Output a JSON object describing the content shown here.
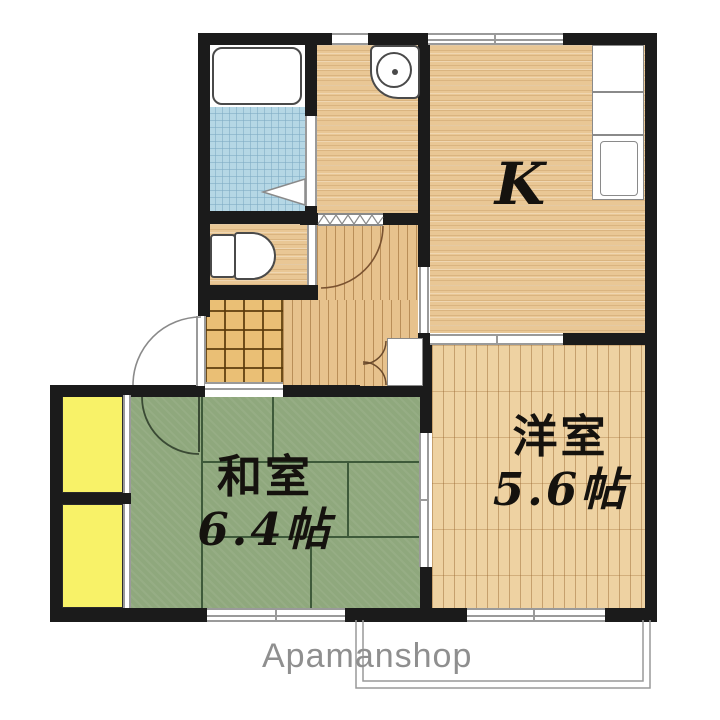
{
  "plan": {
    "watermark": "Apamanshop",
    "rooms": {
      "kitchen": {
        "label": "K"
      },
      "japanese_room": {
        "name": "和室",
        "size": "6.4帖"
      },
      "western_room": {
        "name": "洋室",
        "size": "5.6帖"
      }
    },
    "colors": {
      "wall": "#1b1b1b",
      "tatami_green": "#8fa87d",
      "wood_floor": "#e9c795",
      "western_wood": "#eed2a2",
      "genkan_tile": "#eabf75",
      "bath_tile": "#b5d7e5",
      "closet_yellow": "#f8f268",
      "balcony_line": "#999999",
      "watermark_text": "#8f8f8f"
    }
  }
}
